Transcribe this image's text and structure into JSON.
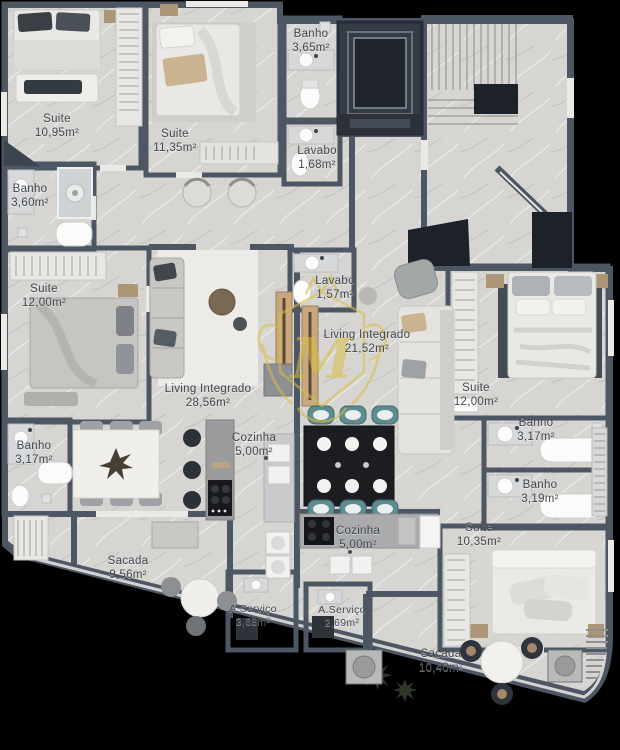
{
  "title": "Planta baixa do pavimento",
  "watermark": {
    "letter": "M",
    "color": "#d9be44"
  },
  "colors": {
    "bg": "#000000",
    "wall": "#4d5663",
    "wood": "#6e5f50",
    "wood_line": "#5e5143",
    "marble": "#d6d5d2",
    "tile": "#e7e8e8",
    "common": "#b2b0ac",
    "dark": "#1d222a",
    "teal": "#5d8d8e",
    "text": "#42474f",
    "railing": "#e2e1de"
  },
  "rooms": [
    {
      "name": "Suite",
      "area": "10,95m²"
    },
    {
      "name": "Suite",
      "area": "11,35m²"
    },
    {
      "name": "Banho",
      "area": "3,65m²"
    },
    {
      "name": "Lavabo",
      "area": "1,68m²"
    },
    {
      "name": "Banho",
      "area": "3,60m²"
    },
    {
      "name": "Suite",
      "area": "12,00m²"
    },
    {
      "name": "Lavabo",
      "area": "1,57m²"
    },
    {
      "name": "Living Integrado",
      "area": "21,52m²"
    },
    {
      "name": "Living Integrado",
      "area": "28,56m²"
    },
    {
      "name": "Cozinha",
      "area": "5,00m²"
    },
    {
      "name": "Banho",
      "area": "3,17m²"
    },
    {
      "name": "Suite",
      "area": "12,00m²"
    },
    {
      "name": "Banho",
      "area": "3,17m²"
    },
    {
      "name": "Banho",
      "area": "3,19m²"
    },
    {
      "name": "Suite",
      "area": "10,35m²"
    },
    {
      "name": "Cozinha",
      "area": "5,00m²"
    },
    {
      "name": "Sacada",
      "area": "9,56m²"
    },
    {
      "name": "A.Serviço",
      "area": "3,68m²"
    },
    {
      "name": "A.Serviço",
      "area": "2,69m²"
    },
    {
      "name": "Sacada",
      "area": "10,40m²"
    }
  ]
}
